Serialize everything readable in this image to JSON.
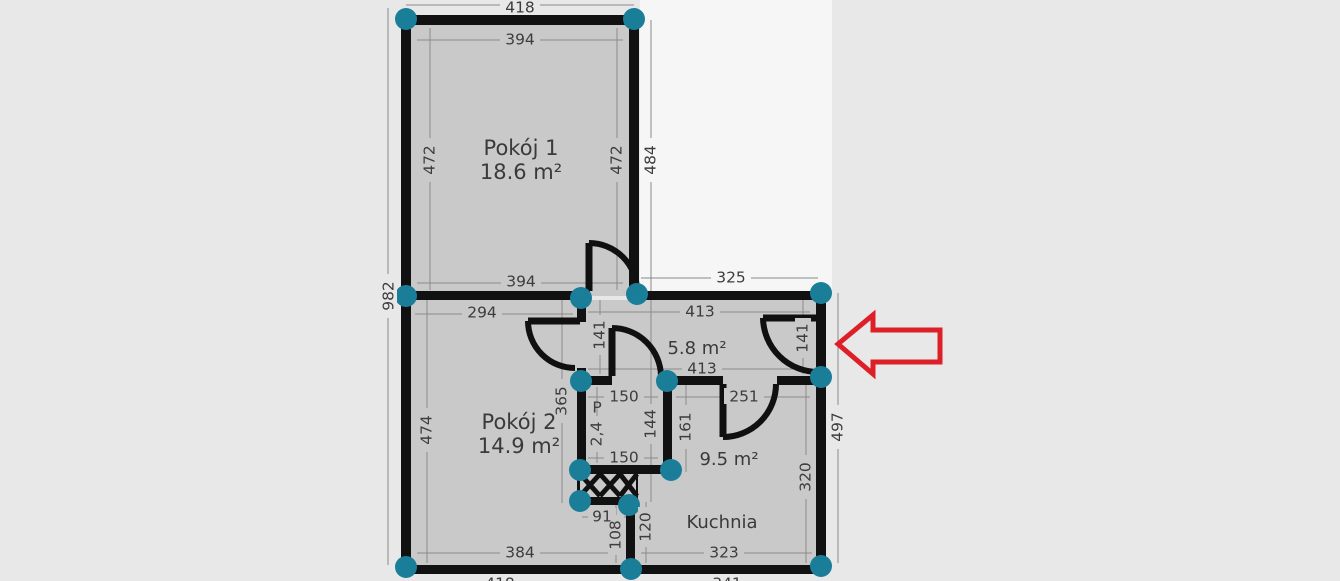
{
  "plan": {
    "type": "floor-plan",
    "rooms": {
      "room1": {
        "name": "Pokój 1",
        "area": "18.6 m²"
      },
      "room2": {
        "name": "Pokój 2",
        "area": "14.9 m²"
      },
      "hall": {
        "area": "5.8 m²"
      },
      "kitchen": {
        "name": "Kuchnia",
        "area": "9.5 m²"
      },
      "small_room": {
        "label": "P",
        "area": "2,4"
      }
    },
    "dims": {
      "d418_top": "418",
      "d394_top": "394",
      "d394_bottom": "394",
      "d294": "294",
      "d325": "325",
      "d413_upper": "413",
      "d413_lower": "413",
      "d251": "251",
      "d150_top": "150",
      "d150_bottom": "150",
      "d91": "91",
      "d384": "384",
      "d323": "323",
      "d418_bottom_clipped": "418",
      "d341_bottom_clipped": "341",
      "d982": "982",
      "d472_left": "472",
      "d472_right": "472",
      "d484": "484",
      "d365": "365",
      "d141_left": "141",
      "d141_right": "141",
      "d474": "474",
      "d161": "161",
      "d320": "320",
      "d497": "497",
      "d144": "144",
      "d108": "108",
      "d120": "120"
    },
    "colors": {
      "background": "#e8e8e8",
      "upper_right_zone": "#f6f6f6",
      "floor": "#c9c9c9",
      "wall": "#111111",
      "node": "#1b7e99",
      "arrow": "#dd2027",
      "dim_text": "#3d3d3d",
      "dim_line": "#6a6a6a"
    }
  }
}
